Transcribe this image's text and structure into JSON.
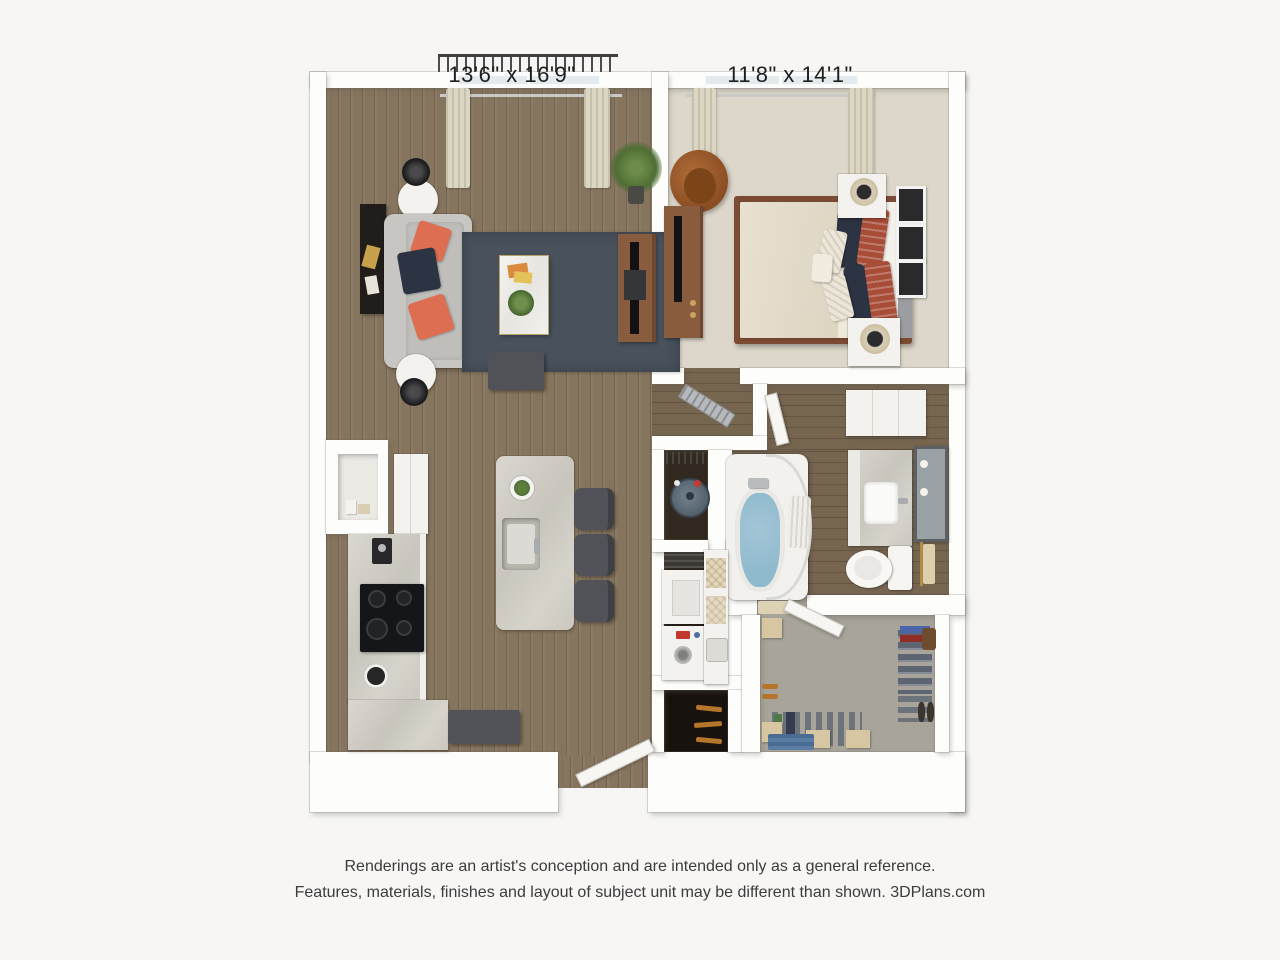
{
  "labels": {
    "living_room_dims": "13'6\" x 16'9\"",
    "bedroom_dims": "11'8\" x 14'1\""
  },
  "footer": {
    "line1": "Renderings are an artist's conception and are intended only as a general reference.",
    "line2": "Features, materials, finishes and layout of subject unit may be different than shown. 3DPlans.com"
  },
  "colors": {
    "wood_floor": "#86755e",
    "wood_floor_dark": "#76654f",
    "carpet_bedroom": "#dcd7ca",
    "carpet_closet": "#a8a49a",
    "wall": "#fdfdfb",
    "rug": "#48515c",
    "sofa": "#c7c6c2",
    "accent_coral": "#dd6e52",
    "accent_navy": "#2c3342",
    "accent_rust": "#a84e38",
    "wood_furniture": "#8a5c3e",
    "tub_water": "#8fb9cd",
    "egg_chair": "#a2602e",
    "duvet": "#e8e1d0",
    "stool": "#515257",
    "heater": "#5a6874"
  }
}
